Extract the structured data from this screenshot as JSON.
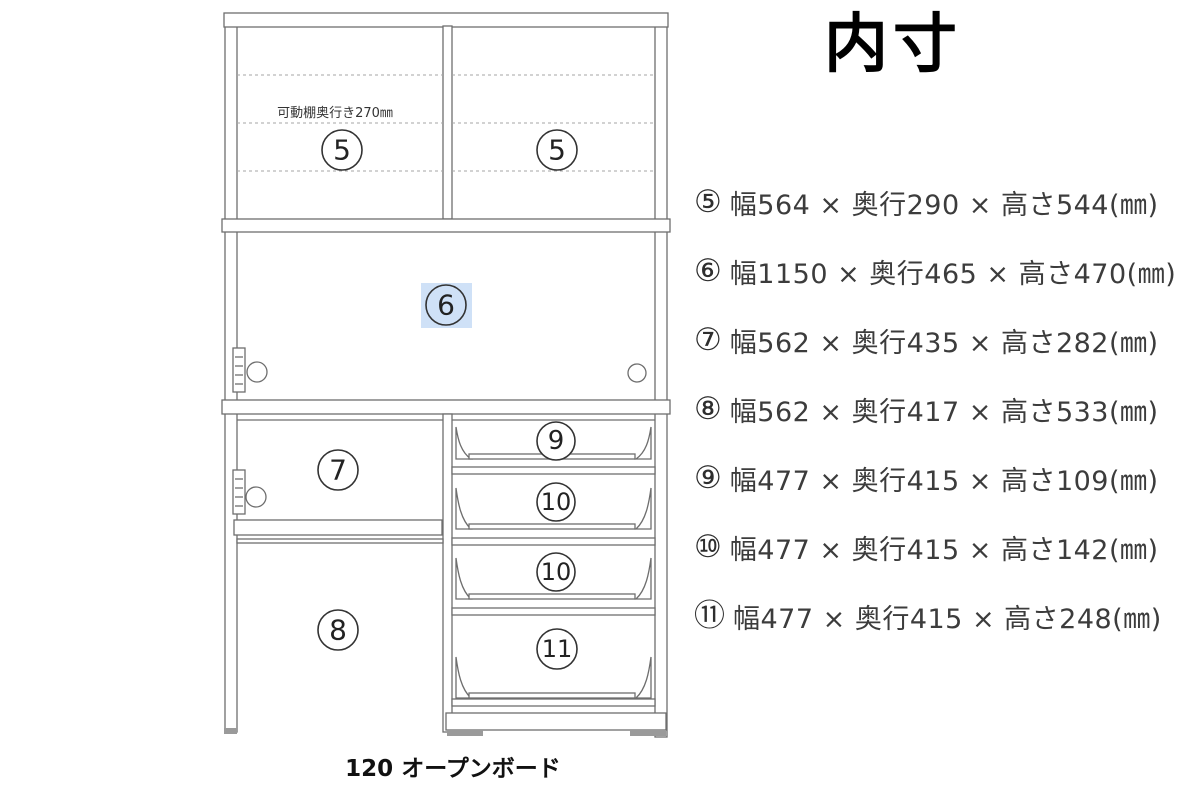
{
  "title": {
    "text": "内寸"
  },
  "specs": {
    "items": [
      {
        "symbol": "⑤",
        "text": "幅564 × 奥行290 × 高さ544(㎜)",
        "width_mm": 564,
        "depth_mm": 290,
        "height_mm": 544
      },
      {
        "symbol": "⑥",
        "text": "幅1150 × 奥行465 × 高さ470(㎜)",
        "width_mm": 1150,
        "depth_mm": 465,
        "height_mm": 470
      },
      {
        "symbol": "⑦",
        "text": "幅562 × 奥行435 × 高さ282(㎜)",
        "width_mm": 562,
        "depth_mm": 435,
        "height_mm": 282
      },
      {
        "symbol": "⑧",
        "text": "幅562 × 奥行417 × 高さ533(㎜)",
        "width_mm": 562,
        "depth_mm": 417,
        "height_mm": 533
      },
      {
        "symbol": "⑨",
        "text": "幅477 × 奥行415 × 高さ109(㎜)",
        "width_mm": 477,
        "depth_mm": 415,
        "height_mm": 109
      },
      {
        "symbol": "⑩",
        "text": "幅477 × 奥行415 × 高さ142(㎜)",
        "width_mm": 477,
        "depth_mm": 415,
        "height_mm": 142
      },
      {
        "symbol": "⑪",
        "text": "幅477 × 奥行415 × 高さ248(㎜)",
        "width_mm": 477,
        "depth_mm": 415,
        "height_mm": 248
      }
    ]
  },
  "diagram": {
    "caption": "120 オープンボード",
    "shelf_note": "可動棚奥行き270㎜",
    "labels": {
      "hutch_left": "5",
      "hutch_right": "5",
      "middle": "6",
      "cabinet_upper_left": "7",
      "cabinet_lower_left": "8",
      "drawer_1": "9",
      "drawer_2": "10",
      "drawer_3": "10",
      "drawer_4": "11"
    },
    "highlight_color": "#cfe1f7",
    "line_color": "#6e6e6e",
    "label_color": "#333333",
    "dash_color": "#a6a6a6",
    "foot_color": "#9a9a9a"
  }
}
